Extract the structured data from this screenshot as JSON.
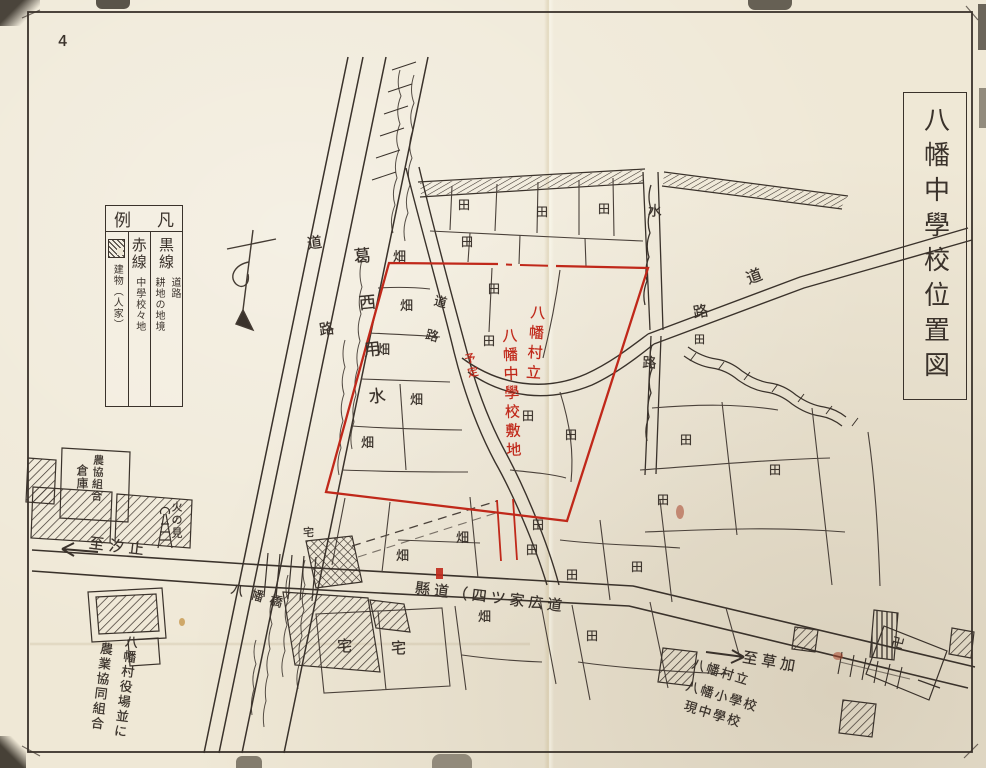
{
  "page": {
    "number": "4"
  },
  "title_box": {
    "text": "八幡中學校位置図"
  },
  "colors": {
    "paper": "#efe8d6",
    "ink": "#3a322b",
    "red": "#c0281a"
  },
  "legend": {
    "header_left": "例",
    "header_right": "凡",
    "columns": [
      {
        "term": "黒線",
        "desc_a": "道路",
        "desc_b": "耕地の地境",
        "symbol": "none"
      },
      {
        "term": "赤線",
        "desc": "中學校々地",
        "symbol": "none"
      },
      {
        "term": "",
        "desc": "建物（人家）",
        "symbol": "hatch-box"
      }
    ]
  },
  "map_labels": [
    {
      "t": "4",
      "x": 58,
      "y": 34,
      "m": "h",
      "s": 15,
      "r": 0,
      "n": "page-number"
    },
    {
      "t": "葛西用水",
      "x": 350,
      "y": 248,
      "m": "v",
      "s": 17,
      "g": 30,
      "r": -6,
      "n": "canal-label"
    },
    {
      "t": "道路",
      "x": 305,
      "y": 236,
      "m": "v",
      "s": 15,
      "g": 72,
      "r": -8,
      "n": "west-road-label"
    },
    {
      "t": "水路",
      "x": 647,
      "y": 203,
      "m": "v",
      "s": 14,
      "g": 138,
      "r": 2,
      "n": "waterway-label"
    },
    {
      "t": "道",
      "x": 744,
      "y": 272,
      "m": "h",
      "s": 16,
      "r": -20,
      "n": "northeast-road-label"
    },
    {
      "t": "路",
      "x": 692,
      "y": 306,
      "m": "h",
      "s": 15,
      "r": -10,
      "n": "northeast-road-label"
    },
    {
      "t": "道路",
      "x": 434,
      "y": 293,
      "m": "v",
      "s": 13,
      "g": 22,
      "r": 14,
      "n": "site-road-label"
    },
    {
      "t": "八幡村立",
      "x": 530,
      "y": 304,
      "m": "v",
      "s": 15,
      "g": 5,
      "r": 4,
      "c": "red",
      "n": "school-site-label-red"
    },
    {
      "t": "八幡中學校敷地",
      "x": 501,
      "y": 328,
      "m": "v",
      "s": 15,
      "g": 4,
      "r": -2,
      "c": "red",
      "n": "school-site-label-red"
    },
    {
      "t": "予定",
      "x": 463,
      "y": 354,
      "m": "v",
      "s": 11,
      "g": 3,
      "r": -12,
      "c": "red",
      "n": "planned-note-red"
    },
    {
      "t": "畑",
      "x": 393,
      "y": 251,
      "m": "h",
      "s": 13,
      "n": "field-label"
    },
    {
      "t": "畑",
      "x": 400,
      "y": 300,
      "m": "h",
      "s": 13,
      "n": "field-label"
    },
    {
      "t": "畑",
      "x": 377,
      "y": 344,
      "m": "h",
      "s": 13,
      "n": "field-label"
    },
    {
      "t": "畑",
      "x": 410,
      "y": 394,
      "m": "h",
      "s": 13,
      "n": "field-label"
    },
    {
      "t": "畑",
      "x": 361,
      "y": 437,
      "m": "h",
      "s": 13,
      "n": "field-label"
    },
    {
      "t": "畑",
      "x": 396,
      "y": 550,
      "m": "h",
      "s": 13,
      "n": "field-label"
    },
    {
      "t": "畑",
      "x": 456,
      "y": 532,
      "m": "h",
      "s": 13,
      "n": "field-label"
    },
    {
      "t": "畑",
      "x": 478,
      "y": 611,
      "m": "h",
      "s": 13,
      "n": "field-label"
    },
    {
      "t": "田",
      "x": 458,
      "y": 199,
      "m": "h",
      "s": 12,
      "n": "paddy-label"
    },
    {
      "t": "田",
      "x": 536,
      "y": 206,
      "m": "h",
      "s": 12,
      "n": "paddy-label"
    },
    {
      "t": "田",
      "x": 598,
      "y": 203,
      "m": "h",
      "s": 12,
      "n": "paddy-label"
    },
    {
      "t": "田",
      "x": 461,
      "y": 236,
      "m": "h",
      "s": 12,
      "n": "paddy-label"
    },
    {
      "t": "田",
      "x": 488,
      "y": 283,
      "m": "h",
      "s": 12,
      "n": "paddy-label"
    },
    {
      "t": "田",
      "x": 483,
      "y": 335,
      "m": "h",
      "s": 12,
      "n": "paddy-label"
    },
    {
      "t": "田",
      "x": 522,
      "y": 410,
      "m": "h",
      "s": 12,
      "n": "paddy-label"
    },
    {
      "t": "田",
      "x": 565,
      "y": 429,
      "m": "h",
      "s": 12,
      "n": "paddy-label"
    },
    {
      "t": "田",
      "x": 532,
      "y": 519,
      "m": "h",
      "s": 12,
      "n": "paddy-label"
    },
    {
      "t": "田",
      "x": 526,
      "y": 544,
      "m": "h",
      "s": 12,
      "n": "paddy-label"
    },
    {
      "t": "田",
      "x": 566,
      "y": 569,
      "m": "h",
      "s": 12,
      "n": "paddy-label"
    },
    {
      "t": "田",
      "x": 631,
      "y": 561,
      "m": "h",
      "s": 12,
      "n": "paddy-label"
    },
    {
      "t": "田",
      "x": 586,
      "y": 630,
      "m": "h",
      "s": 12,
      "n": "paddy-label"
    },
    {
      "t": "田",
      "x": 680,
      "y": 434,
      "m": "h",
      "s": 12,
      "n": "paddy-label"
    },
    {
      "t": "田",
      "x": 657,
      "y": 494,
      "m": "h",
      "s": 12,
      "n": "paddy-label"
    },
    {
      "t": "田",
      "x": 694,
      "y": 334,
      "m": "h",
      "s": 11,
      "n": "paddy-label"
    },
    {
      "t": "田",
      "x": 769,
      "y": 464,
      "m": "h",
      "s": 12,
      "n": "paddy-label"
    },
    {
      "t": "宅",
      "x": 303,
      "y": 527,
      "m": "h",
      "s": 11,
      "n": "house-plot-label"
    },
    {
      "t": "宅",
      "x": 337,
      "y": 639,
      "m": "h",
      "s": 15,
      "n": "house-plot-label"
    },
    {
      "t": "宅",
      "x": 391,
      "y": 641,
      "m": "h",
      "s": 15,
      "n": "house-plot-label"
    },
    {
      "t": "八幡橋",
      "x": 233,
      "y": 583,
      "m": "h",
      "s": 13,
      "g": 7,
      "r": 16,
      "n": "bridge-label"
    },
    {
      "t": "至汐止",
      "x": 90,
      "y": 536,
      "m": "h",
      "s": 15,
      "g": 5,
      "r": 7,
      "n": "to-shiodome-label"
    },
    {
      "t": "縣道（四ツ家広道",
      "x": 416,
      "y": 581,
      "m": "h",
      "s": 15,
      "g": 4,
      "r": 7,
      "n": "prefectural-road-label"
    },
    {
      "t": "至草加",
      "x": 744,
      "y": 650,
      "m": "h",
      "s": 15,
      "g": 4,
      "r": 10,
      "n": "to-soka-label"
    },
    {
      "t": "八幡村立",
      "x": 694,
      "y": 658,
      "m": "h",
      "s": 13,
      "g": 2,
      "r": 17,
      "n": "elementary-school-label"
    },
    {
      "t": "八幡小學校",
      "x": 688,
      "y": 680,
      "m": "h",
      "s": 13,
      "g": 2,
      "r": 17,
      "n": "elementary-school-label"
    },
    {
      "t": "現中學校",
      "x": 686,
      "y": 700,
      "m": "h",
      "s": 13,
      "g": 2,
      "r": 17,
      "n": "elementary-school-label"
    },
    {
      "t": "八幡村役場並に",
      "x": 124,
      "y": 634,
      "m": "v",
      "s": 13,
      "g": 2,
      "r": 7,
      "n": "village-office-label"
    },
    {
      "t": "農業協同組合",
      "x": 99,
      "y": 641,
      "m": "v",
      "s": 13,
      "g": 2,
      "r": 7,
      "n": "agri-coop-label"
    },
    {
      "t": "農協組合",
      "x": 93,
      "y": 454,
      "m": "v",
      "s": 11,
      "g": 1,
      "r": 3,
      "n": "coop-warehouse-label"
    },
    {
      "t": "倉庫",
      "x": 76,
      "y": 464,
      "m": "v",
      "s": 12,
      "g": 1,
      "r": 0,
      "n": "coop-warehouse-label"
    },
    {
      "t": "火の見",
      "x": 171,
      "y": 501,
      "m": "v",
      "s": 11,
      "g": 2,
      "r": 0,
      "n": "fire-lookout-label"
    },
    {
      "t": "卍",
      "x": 893,
      "y": 636,
      "m": "h",
      "s": 13,
      "r": 15,
      "n": "temple-symbol"
    }
  ]
}
